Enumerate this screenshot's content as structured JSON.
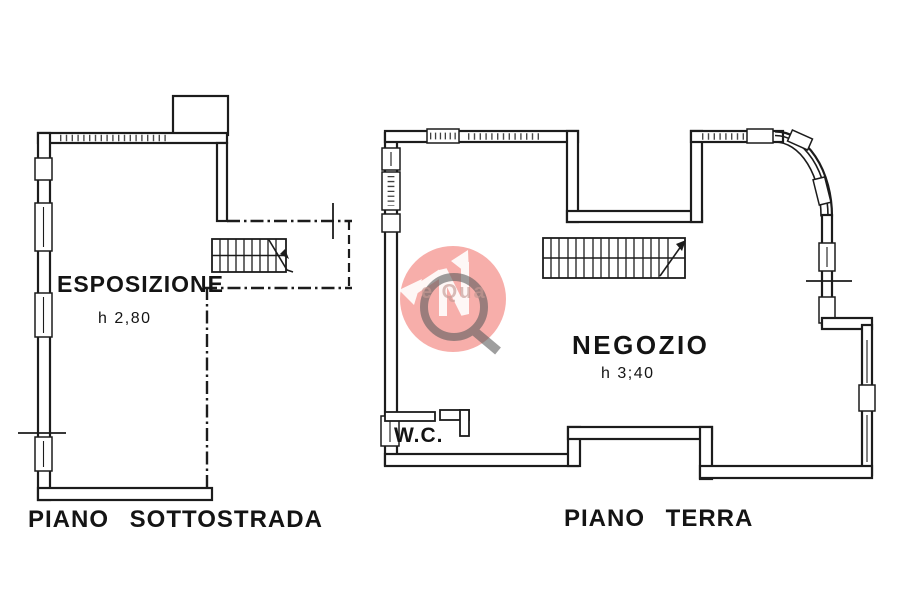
{
  "left_plan": {
    "room_label": "ESPOSIZIONE",
    "height_label": "h 2,80",
    "caption": "PIANO  SOTTOSTRADA"
  },
  "right_plan": {
    "room_label": "NEGOZIO",
    "height_label": "h 3;40",
    "wc_label": "W.C.",
    "caption": "PIANO  TERRA"
  },
  "watermark": {
    "partial_text": "e Qua",
    "circle_color": "#ee4b42",
    "q_color": "#5e5e5e"
  },
  "colors": {
    "ink": "#1c1c1c",
    "background": "#ffffff"
  }
}
